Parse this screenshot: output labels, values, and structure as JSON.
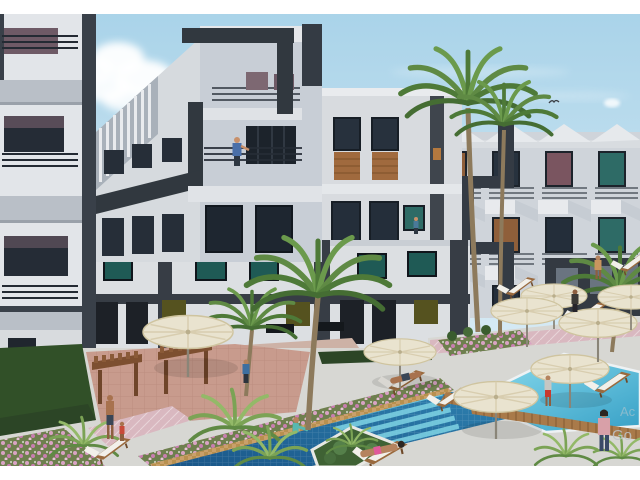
{
  "image": {
    "type": "3d-architectural-rendering",
    "subject": "Modern white apartment complex courtyard with swimming pools, palm trees and sun umbrellas",
    "frame_color": "#ffffff"
  },
  "watermark": {
    "line1": "Ac",
    "line2": "Go"
  },
  "palette": {
    "sky_top": "#a9d3e9",
    "sky_bottom": "#d6eaf4",
    "cloud": "#ffffff",
    "facade_light": "#e2e5e9",
    "facade_mid": "#cfd4da",
    "facade_shadow": "#b9bfc7",
    "accent_charcoal": "#394049",
    "window_glass": "#242e3a",
    "window_teal": "#2e6b66",
    "window_olive": "#55521f",
    "wood_panel": "#a06a3e",
    "pool_deep": "#1a5688",
    "pool_mid": "#2f83b2",
    "pool_steps": "#7fd4e4",
    "pool_turquoise_light": "#8fdff0",
    "pool_turquoise_deep": "#37a0c6",
    "umbrella_cream": "#e9e3cf",
    "flower_pink": "#d9a3c4",
    "terrace_terracotta": "#c89b8d",
    "walkway_pink": "#d9b8c0",
    "lawn_green": "#315028",
    "palm_green": "#5f8a44",
    "pergola_wood": "#7d4f30",
    "deck_concrete": "#d7d7d3",
    "wood_deck": "#a97a4a"
  },
  "scene": {
    "buildings": [
      "left-tower-with-balconies",
      "center-corner-building-with-charcoal-frames",
      "middle-building-with-wood-panels",
      "right-terraced-balcony-building",
      "courtyard-ground-wing"
    ],
    "amenities": [
      "main-swimming-pool-with-steps",
      "side-turquoise-pool",
      "cream-pool-umbrellas",
      "wooden-sun-loungers",
      "timber-pergolas",
      "palm-trees",
      "pink-flower-beds"
    ],
    "umbrella_count": 8,
    "lounger_count": 9,
    "people_count": 12,
    "sky": "clear light blue with one soft cloud and a distant bird"
  }
}
